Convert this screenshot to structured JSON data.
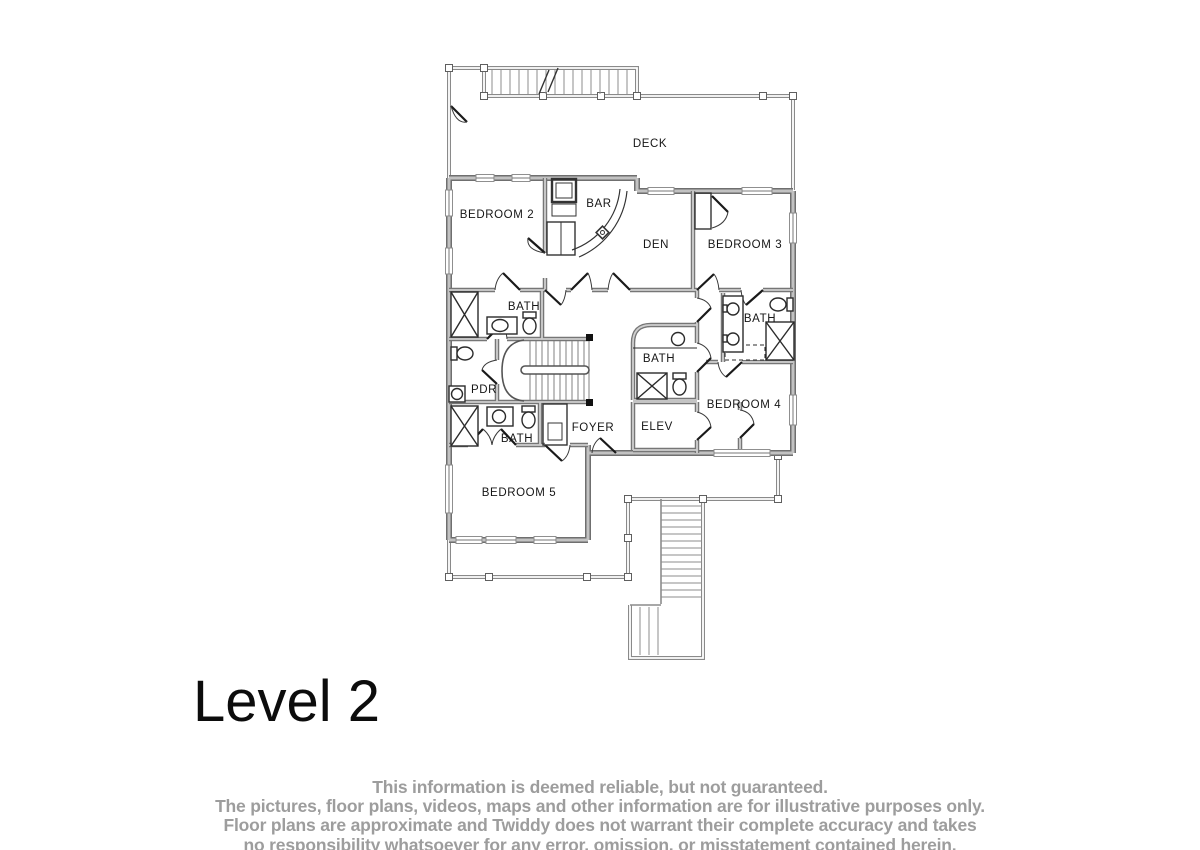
{
  "title": "Level 2",
  "floorplan": {
    "rooms": {
      "deck": "DECK",
      "bedroom2": "BEDROOM 2",
      "bar": "BAR",
      "den": "DEN",
      "bedroom3": "BEDROOM 3",
      "bath_upper_left": "BATH",
      "bath_center": "BATH",
      "bath_right": "BATH",
      "bath_lower_left": "BATH",
      "pdr": "PDR",
      "bedroom4": "BEDROOM 4",
      "foyer": "FOYER",
      "elev": "ELEV",
      "bedroom5": "BEDROOM 5"
    }
  },
  "disclaimer": {
    "line1": "This information is deemed reliable, but not guaranteed.",
    "line2": "The pictures, floor plans, videos, maps and other information are for illustrative purposes only.",
    "line3": "Floor plans are approximate and Twiddy does not warrant their complete accuracy and takes",
    "line4": "no responsibility whatsoever for any error, omission, or misstatement contained herein."
  },
  "colors": {
    "wall_edge": "#6f6f6f",
    "wall_fill": "#c2c2c2",
    "rail": "#8a8a8a",
    "label": "#161616",
    "disclaimer_text": "#9d9d9d"
  }
}
